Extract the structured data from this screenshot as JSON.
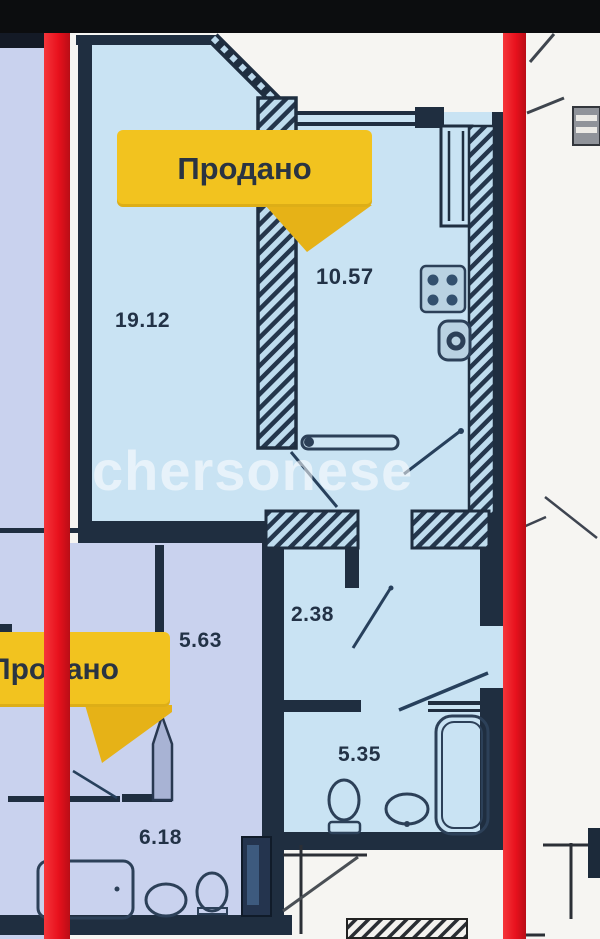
{
  "plan": {
    "watermark": "chersonese",
    "badges": [
      {
        "label": "Продано"
      },
      {
        "label": "Продано"
      }
    ],
    "areas": [
      {
        "id": "living-room",
        "value": "19.12"
      },
      {
        "id": "kitchen",
        "value": "10.57"
      },
      {
        "id": "neighbor-room-top",
        "value": "5.63"
      },
      {
        "id": "hallway",
        "value": "2.38"
      },
      {
        "id": "bathroom",
        "value": "5.35"
      },
      {
        "id": "neighbor-room-bottom",
        "value": "6.18"
      }
    ]
  },
  "colors": {
    "floor_blue": "#c9e3f3",
    "floor_lavender": "#c9d2ee",
    "wall_navy": "#1f2e40",
    "highlight_red": "#e8111d",
    "badge_yellow": "#f2c31f",
    "badge_text": "#2a3442",
    "background_white": "#f6f5f2",
    "top_bar_black": "#0c0d0f",
    "label_navy": "#223246"
  }
}
